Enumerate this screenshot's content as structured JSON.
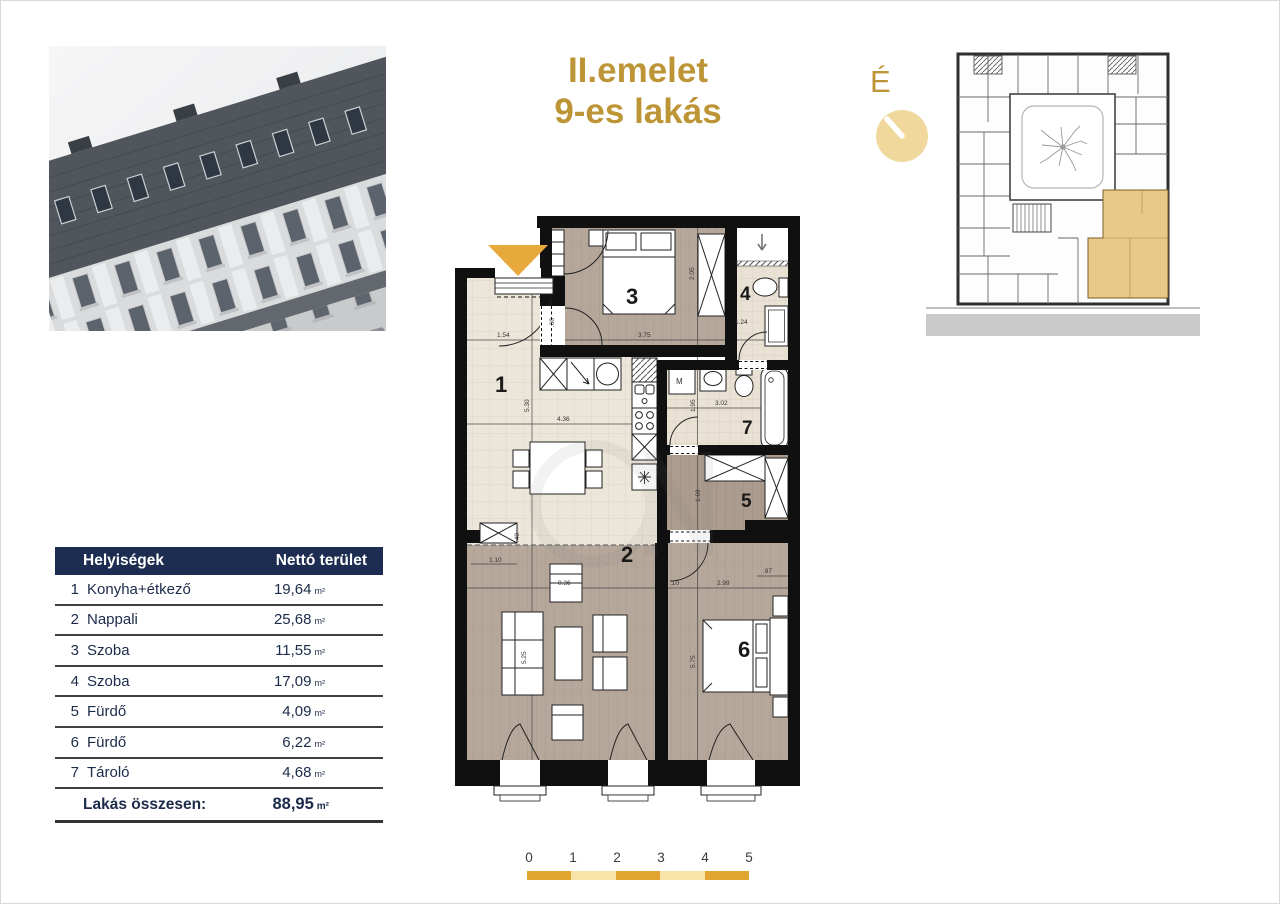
{
  "title": {
    "line1": "II.emelet",
    "line2": "9-es lakás"
  },
  "north": {
    "label": "É"
  },
  "rooms_table": {
    "col1": "Helyiségek",
    "col2": "Nettó terület",
    "rows": [
      {
        "num": "1",
        "name": "Konyha+étkező",
        "area": "19,64",
        "unit": "m²"
      },
      {
        "num": "2",
        "name": "Nappali",
        "area": "25,68",
        "unit": "m²"
      },
      {
        "num": "3",
        "name": "Szoba",
        "area": "11,55",
        "unit": "m²"
      },
      {
        "num": "4",
        "name": "Szoba",
        "area": "17,09",
        "unit": "m²"
      },
      {
        "num": "5",
        "name": "Fürdő",
        "area": "4,09",
        "unit": "m²"
      },
      {
        "num": "6",
        "name": "Fürdő",
        "area": "6,22",
        "unit": "m²"
      },
      {
        "num": "7",
        "name": "Tároló",
        "area": "4,68",
        "unit": "m²"
      }
    ],
    "total_label": "Lakás összesen:",
    "total_area": "88,95",
    "total_unit": "m²"
  },
  "floorplan": {
    "rooms": [
      {
        "label": "1"
      },
      {
        "label": "2"
      },
      {
        "label": "3"
      },
      {
        "label": "4"
      },
      {
        "label": "5"
      },
      {
        "label": "6"
      },
      {
        "label": "7"
      }
    ],
    "washer": "M",
    "dims": {
      "a": "1.54",
      "b": ".60",
      "c": "3.75",
      "d": "2.05",
      "e": "1.24",
      "f": "5.30",
      "g": "4.36",
      "h": ".40",
      "i": "1.95",
      "j": "3.02",
      "k": "1.69",
      "l": "1.10",
      "m": "0.36",
      "n": "5.25",
      "o": ".10",
      "p": "2.99",
      "q": ".97",
      "r": "5.75"
    }
  },
  "scalebar": {
    "ticks": [
      "0",
      "1",
      "2",
      "3",
      "4",
      "5"
    ]
  },
  "colors": {
    "gold": "#BD9536",
    "amber": "#E8A93C",
    "amber_light": "#F8E3A8",
    "navy": "#1D2D51",
    "plan_highlight": "#E9C98A"
  }
}
